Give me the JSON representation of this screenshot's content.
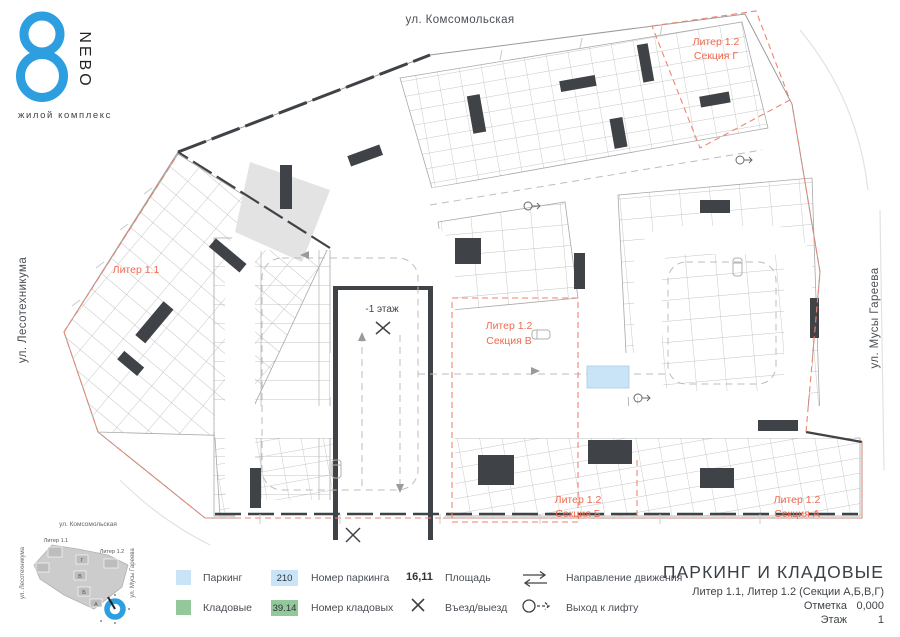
{
  "logo": {
    "glyph": "8",
    "brand": "NEBO",
    "subtitle": "жилой комплекс"
  },
  "streets": {
    "top": "ул. Комсомольская",
    "left": "ул. Лесотехникума",
    "right": "ул. Мусы Гареева"
  },
  "plan": {
    "liter11": "Литер 1.1",
    "sec_g1": "Литер 1.2",
    "sec_g2": "Секция Г",
    "sec_v1": "Литер 1.2",
    "sec_v2": "Секция В",
    "sec_b1": "Литер 1.2",
    "sec_b2": "Секция Б",
    "sec_a1": "Литер 1.2",
    "sec_a2": "Секция А",
    "ramp": "-1 этаж"
  },
  "legend": {
    "parking": "Паркинг",
    "storage": "Кладовые",
    "parking_no": "210",
    "parking_no_label": "Номер паркинга",
    "storage_no": "39.14",
    "storage_no_label": "Номер кладовых",
    "area_no": "16,11",
    "area_label": "Площадь",
    "entry": "Въезд/выезд",
    "direction": "Направление движения",
    "lift": "Выход к лифту"
  },
  "title_block": {
    "title": "ПАРКИНГ И КЛАДОВЫЕ",
    "subtitle": "Литер 1.1, Литер 1.2 (Секции А,Б,В,Г)",
    "mark_label": "Отметка",
    "mark_value": "0,000",
    "floor_label": "Этаж",
    "floor_value": "1"
  },
  "minimap": {
    "street_top": "ул. Комсомольская",
    "street_left": "ул. Лесотехникума",
    "street_right": "ул. Мусы Гареева",
    "liter11": "Литер 1.1",
    "liter12": "Литер 1.2",
    "sec_a": "А",
    "sec_b": "Б",
    "sec_v": "В",
    "sec_g": "Г"
  },
  "colors": {
    "parking_fill": "#c9e4f6",
    "storage_fill": "#93c89b",
    "accent": "#ee6a50",
    "walls": "#3f4347",
    "logo_blue": "#2d9fe0"
  }
}
